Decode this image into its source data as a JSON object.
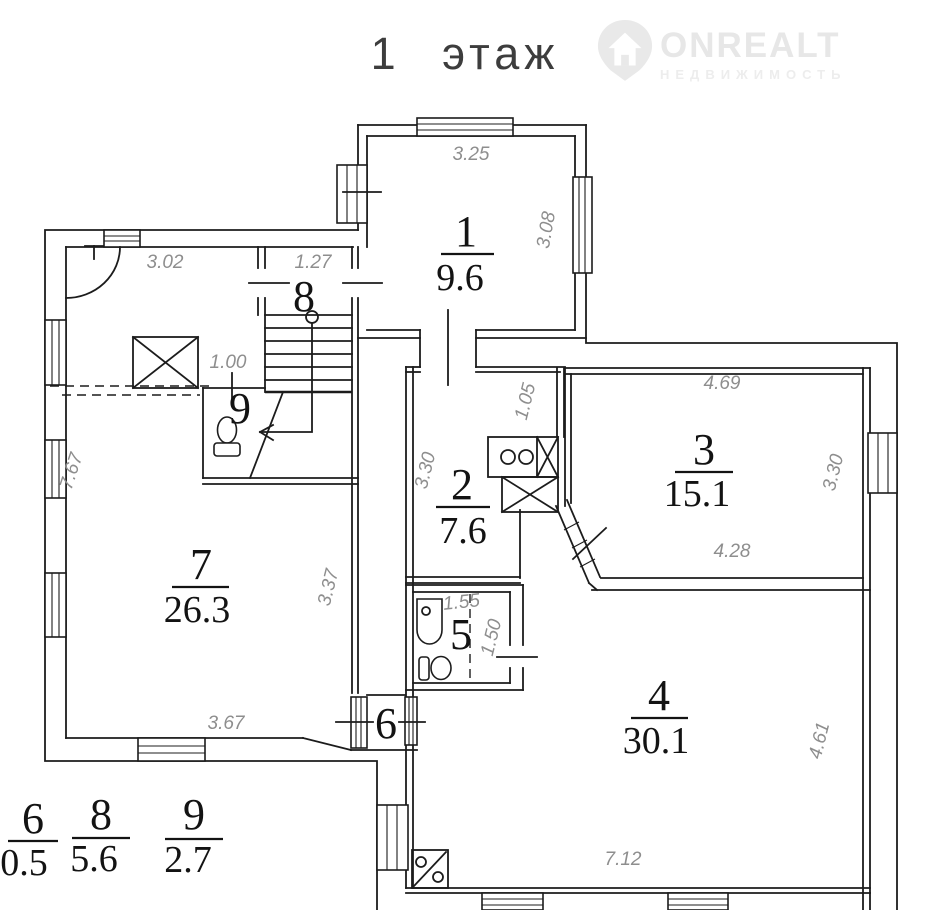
{
  "title": "1 этаж",
  "logo": {
    "brand": "ONREALT",
    "tagline": "НЕДВИЖИМОСТЬ"
  },
  "rooms": {
    "r1": {
      "number": "1",
      "area": "9.6"
    },
    "r2": {
      "number": "2",
      "area": "7.6"
    },
    "r3": {
      "number": "3",
      "area": "15.1"
    },
    "r4": {
      "number": "4",
      "area": "30.1"
    },
    "r5": {
      "number": "5"
    },
    "r6": {
      "number": "6"
    },
    "r7": {
      "number": "7",
      "area": "26.3"
    },
    "r8": {
      "number": "8"
    },
    "r9": {
      "number": "9"
    }
  },
  "legend": {
    "items": [
      {
        "number": "6",
        "area": "0.5"
      },
      {
        "number": "8",
        "area": "5.6"
      },
      {
        "number": "9",
        "area": "2.7"
      }
    ]
  },
  "dimensions": {
    "room1_top": "3.25",
    "room1_right": "3.08",
    "hall_top": "3.02",
    "room8_top": "1.27",
    "wc_door": "1.00",
    "kitchen_niche": "1.05",
    "room2_left": "3.30",
    "room3_top": "4.69",
    "room3_right": "3.30",
    "room3_bottom": "4.28",
    "room7_left": "7.67",
    "room7_right": "3.37",
    "bath_top": "1.55",
    "bath_right": "1.50",
    "room7_bottom": "3.67",
    "room4_right": "4.61",
    "room4_bottom": "7.12"
  },
  "colors": {
    "wall": "#1c1c1c",
    "dimension_text": "#8e8e8e",
    "watermark": "#e7e7e7",
    "background": "#ffffff"
  }
}
